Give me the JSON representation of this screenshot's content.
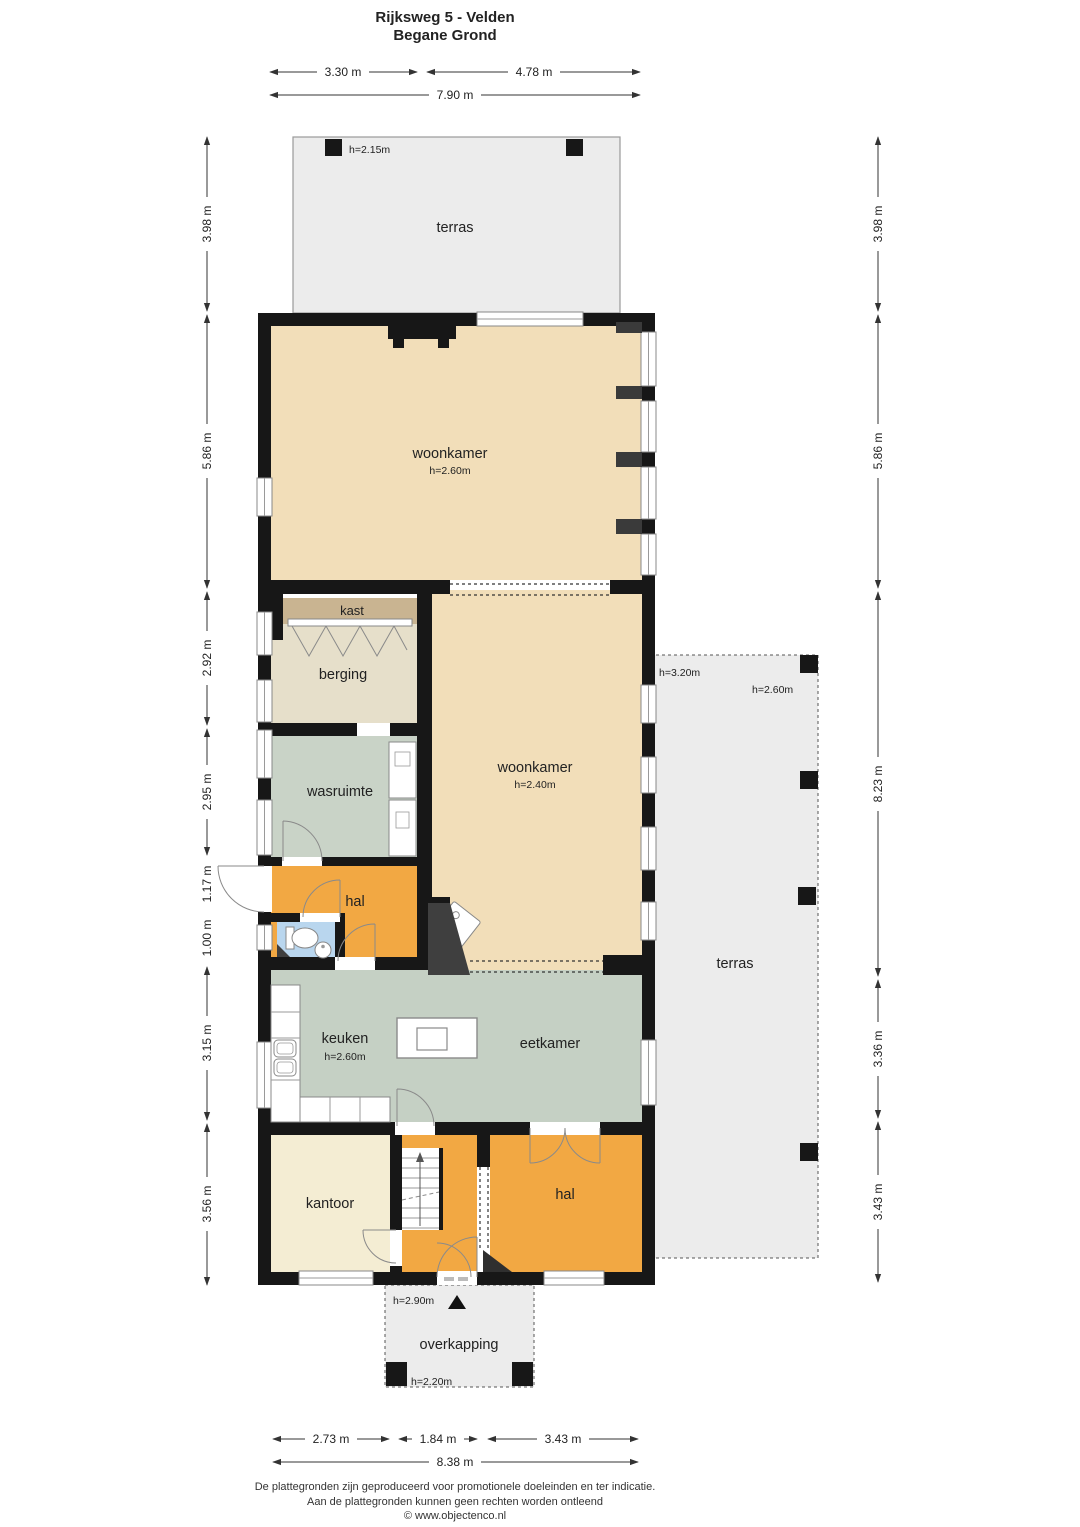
{
  "title": {
    "line1": "Rijksweg 5 - Velden",
    "line2": "Begane Grond"
  },
  "rooms": {
    "terras_top": {
      "label": "terras",
      "height": "h=2.15m"
    },
    "woonkamer_1": {
      "label": "woonkamer",
      "height": "h=2.60m"
    },
    "kast": {
      "label": "kast"
    },
    "berging": {
      "label": "berging"
    },
    "wasruimte": {
      "label": "wasruimte"
    },
    "hal_1": {
      "label": "hal"
    },
    "woonkamer_2": {
      "label": "woonkamer",
      "height": "h=2.40m"
    },
    "terras_right": {
      "label": "terras",
      "height_wall": "h=3.20m",
      "height_post": "h=2.60m"
    },
    "keuken": {
      "label": "keuken",
      "height": "h=2.60m"
    },
    "eetkamer": {
      "label": "eetkamer"
    },
    "kantoor": {
      "label": "kantoor"
    },
    "hal_2": {
      "label": "hal"
    },
    "overkapping": {
      "label": "overkapping",
      "height_top": "h=2.90m",
      "height_post": "h=2.20m"
    }
  },
  "dimensions": {
    "top": [
      "3.30 m",
      "4.78 m",
      "7.90 m"
    ],
    "bottom": [
      "2.73 m",
      "1.84 m",
      "3.43 m",
      "8.38 m"
    ],
    "left": [
      "3.98 m",
      "5.86 m",
      "2.92 m",
      "2.95 m",
      "1.17 m",
      "1.00 m",
      "3.15 m",
      "3.56 m"
    ],
    "right": [
      "3.98 m",
      "5.86 m",
      "8.23 m",
      "3.36 m",
      "3.43 m"
    ]
  },
  "footer": {
    "line1": "De plattegronden zijn geproduceerd voor promotionele doeleinden en ter indicatie.",
    "line2": "Aan de plattegronden kunnen geen rechten worden ontleend",
    "line3": "© www.objectenco.nl"
  },
  "colors": {
    "wall": "#171717",
    "woonkamer": "#f2deb9",
    "kast": "#c9b491",
    "berging": "#e6dfca",
    "wasruimte": "#c9d3c7",
    "keuken": "#c5d0c4",
    "hal": "#f2a843",
    "kantoor": "#f4edd3",
    "toilet": "#b9d6ee",
    "terras": "#ececec",
    "accent_dark": "#3f3f3f"
  }
}
